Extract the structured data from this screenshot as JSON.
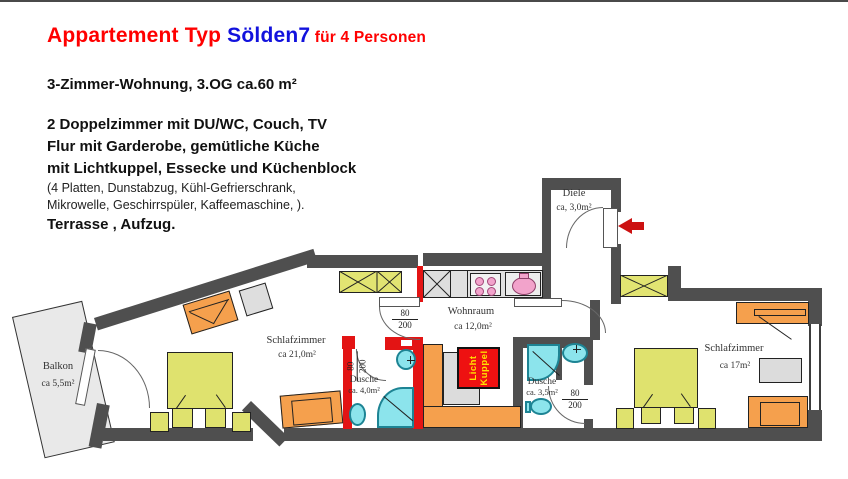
{
  "header": {
    "title_main": "Appartement Typ ",
    "title_highlight": "Sölden7",
    "title_suffix": " für 4 Personen",
    "subtitle": "3-Zimmer-Wohnung, 3.OG ca.60 m²",
    "description": {
      "line1": "2 Doppelzimmer mit DU/WC, Couch, TV",
      "line2": "Flur mit Garderobe, gemütliche Küche",
      "line3": "mit Lichtkuppel, Essecke und Küchenblock",
      "line4": "(4 Platten, Dunstabzug, Kühl-Gefrierschrank,",
      "line5": "Mikrowelle, Geschirrspüler, Kaffeemaschine, ).",
      "line6": "Terrasse , Aufzug."
    }
  },
  "floorplan": {
    "rooms": {
      "balkon": {
        "name": "Balkon",
        "area": "ca 5,5m²"
      },
      "schlafzimmer1": {
        "name": "Schlafzimmer",
        "area": "ca 21,0m²"
      },
      "dusche1": {
        "name": "Dusche",
        "area": "ca. 4,0m²"
      },
      "wohnraum": {
        "name": "Wohnraum",
        "area": "ca 12,0m²"
      },
      "dusche2": {
        "name": "Dusche",
        "area": "ca. 3,5m²"
      },
      "diele": {
        "name": "Diele",
        "area": "ca, 3,0m²"
      },
      "schlafzimmer2": {
        "name": "Schlafzimmer",
        "area": "ca 17m²"
      }
    },
    "skylight": {
      "line1": "Licht",
      "line2": "Kuppel"
    },
    "door_size": {
      "width": "80",
      "height": "200"
    }
  },
  "colors": {
    "title_red": "#ff0000",
    "title_blue": "#1212dd",
    "wall_gray": "#4f4f4f",
    "bath_wall_red": "#e31414",
    "furniture_orange": "#f5a04d",
    "furniture_yellow": "#dfe26e",
    "fixture_cyan": "#8ce4ec",
    "skylight_red": "#ee1111",
    "skylight_text_yellow": "#ffe000",
    "kitchen_pink": "#f2a3cb"
  }
}
